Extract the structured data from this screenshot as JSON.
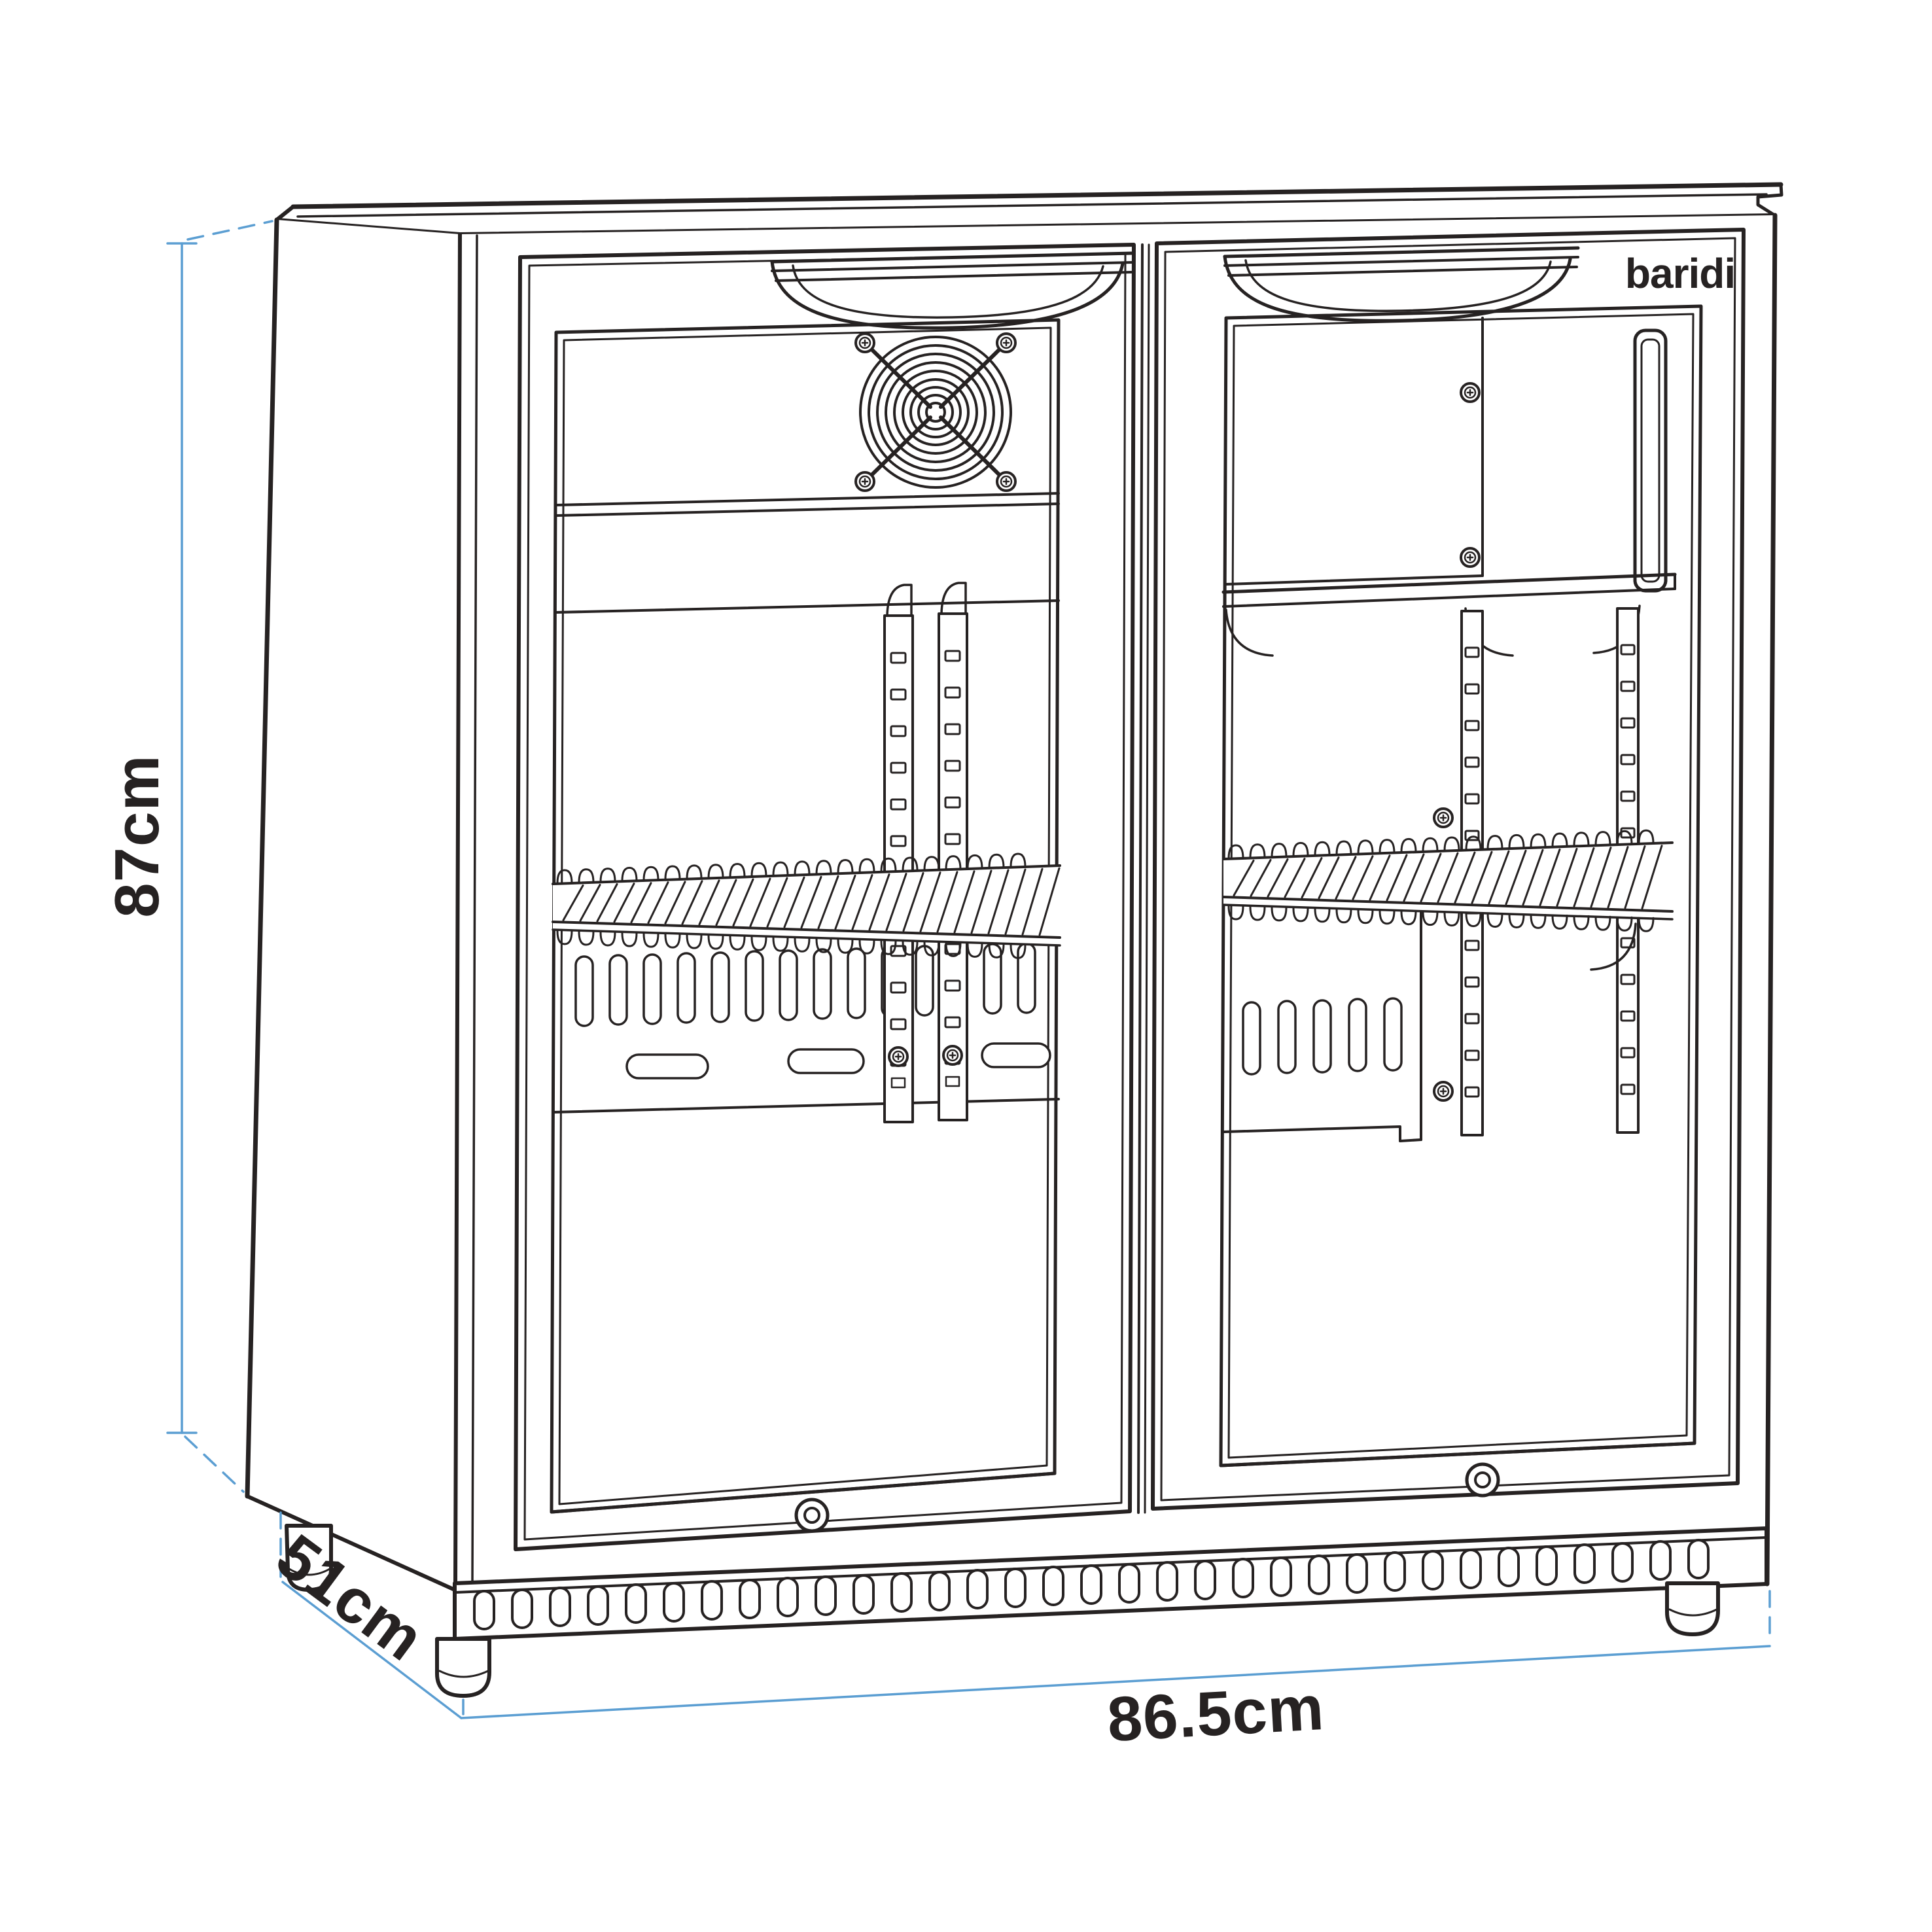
{
  "page": {
    "background": "#ffffff"
  },
  "brand": {
    "logo_text": "baridi"
  },
  "dimensions": {
    "height": {
      "label": "87cm"
    },
    "depth": {
      "label": "51cm"
    },
    "width": {
      "label": "86.5cm"
    }
  },
  "colors": {
    "line": "#262222",
    "dim": "#5b9ed2"
  },
  "icons": [
    "fan-grille-icon",
    "door-lock-icon",
    "screw-icon",
    "recessed-handle",
    "adjustable-foot",
    "vent-grille"
  ]
}
